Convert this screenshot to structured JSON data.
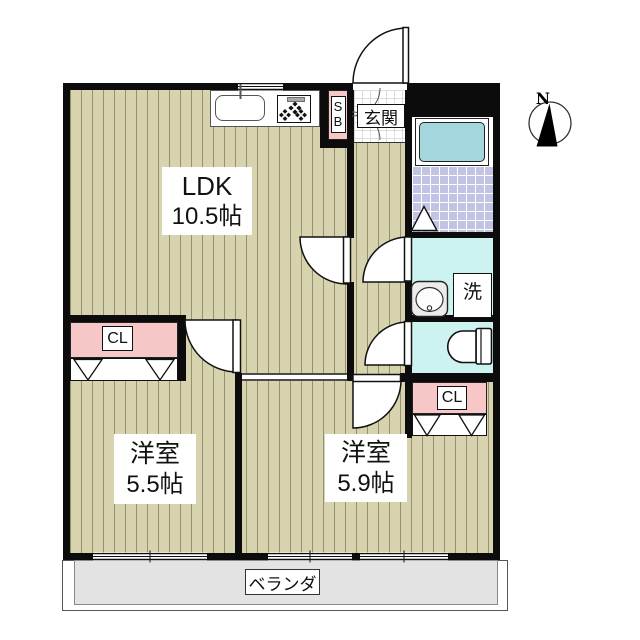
{
  "plan": {
    "type": "apartment-floorplan",
    "compass": {
      "label": "N"
    },
    "rooms": {
      "ldk": {
        "name": "LDK",
        "size": "10.5帖"
      },
      "bedroom_left": {
        "name": "洋室",
        "size": "5.5帖"
      },
      "bedroom_right": {
        "name": "洋室",
        "size": "5.9帖"
      },
      "entrance": {
        "label": "玄関"
      },
      "shoe_box": {
        "line1": "S",
        "line2": "B"
      },
      "closet_left": {
        "label": "CL"
      },
      "closet_right": {
        "label": "CL"
      },
      "laundry": {
        "label": "洗"
      },
      "veranda": {
        "label": "ベランダ"
      }
    },
    "icons": [
      "compass-icon",
      "kitchen-sink-icon",
      "stove-icon",
      "bathtub-icon",
      "bath-door-triangle-icon",
      "toilet-icon",
      "washbasin-icon",
      "door-swing-icon",
      "closet-door-triangle-icon",
      "window-icon"
    ],
    "colors": {
      "wall": "#0c0c0c",
      "wood_floor": "#d7d3ae",
      "wood_stripe": "#5c5a3e",
      "closet_pink": "#f7c6c6",
      "bathtub_blue": "#a4d7dd",
      "bath_tile_lavender": "#c3c3e3",
      "wet_area_cyan": "#cdf3f1",
      "veranda_gray": "#e3e3e3"
    }
  }
}
